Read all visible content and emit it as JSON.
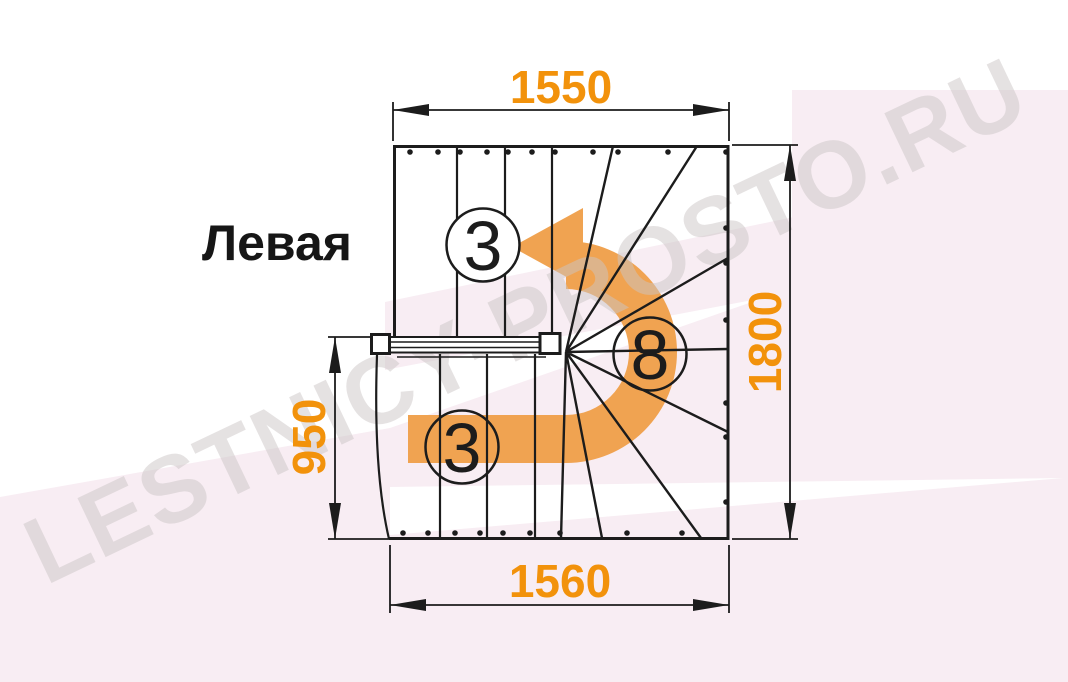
{
  "drawing": {
    "title_label": "Левая",
    "watermark_text": "LESTNICY-PROSTO.RU",
    "dimensions_mm": {
      "top_width": "1550",
      "right_height": "1800",
      "left_height": "950",
      "bottom_width": "1560"
    },
    "step_counts": {
      "upper_flight": "3",
      "winder_turn": "8",
      "lower_flight": "3"
    },
    "colors": {
      "dimension_text": "#F2920B",
      "direction_arrow": "#F0A351",
      "drawing_line": "#1c1c1c",
      "background_tint": "#F8EDF3",
      "watermark_gray": "#CCC6C6"
    }
  }
}
